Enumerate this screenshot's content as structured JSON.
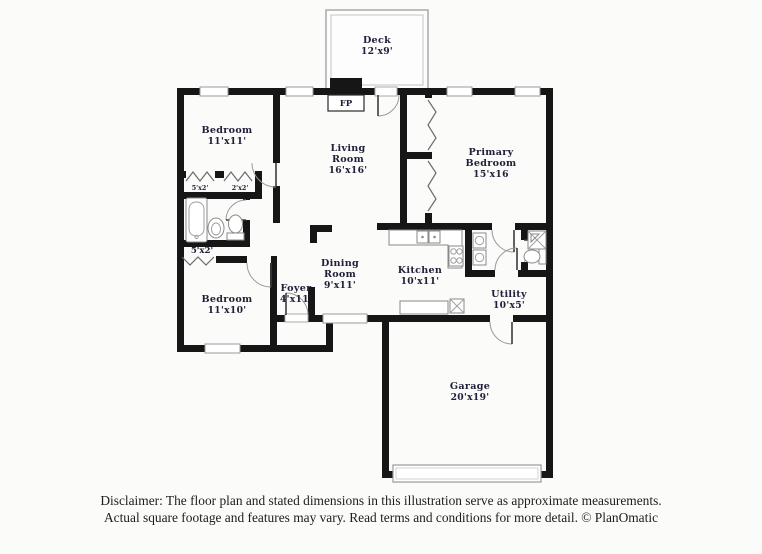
{
  "rooms": {
    "deck": {
      "line1": "Deck",
      "dims": "12'x9'"
    },
    "bedroom1": {
      "line1": "Bedroom",
      "dims": "11'x11'"
    },
    "living": {
      "line1": "Living",
      "line2": "Room",
      "dims": "16'x16'"
    },
    "primary": {
      "line1": "Primary",
      "line2": "Bedroom",
      "dims": "15'x16"
    },
    "bedroom2": {
      "line1": "Bedroom",
      "dims": "11'x10'"
    },
    "foyer": {
      "line1": "Foyer",
      "dims": "4'x11'"
    },
    "dining": {
      "line1": "Dining",
      "line2": "Room",
      "dims": "9'x11'"
    },
    "kitchen": {
      "line1": "Kitchen",
      "dims": "10'x11'"
    },
    "utility": {
      "line1": "Utility",
      "dims": "10'x5'"
    },
    "garage": {
      "line1": "Garage",
      "dims": "20'x19'"
    }
  },
  "closets": {
    "small_left": "5'x2'",
    "small_right": "2'x2'",
    "hall": "5'x2'"
  },
  "fireplace_label": "FP",
  "footer": {
    "line1": "Disclaimer: The floor plan and stated dimensions in this illustration serve as approximate measurements.",
    "line2": "Actual square footage and features may vary. Read terms and conditions for more detail. © PlanOmatic"
  },
  "colors": {
    "wall": "#161616",
    "label": "#20203a",
    "background": "#fbfbfa"
  }
}
